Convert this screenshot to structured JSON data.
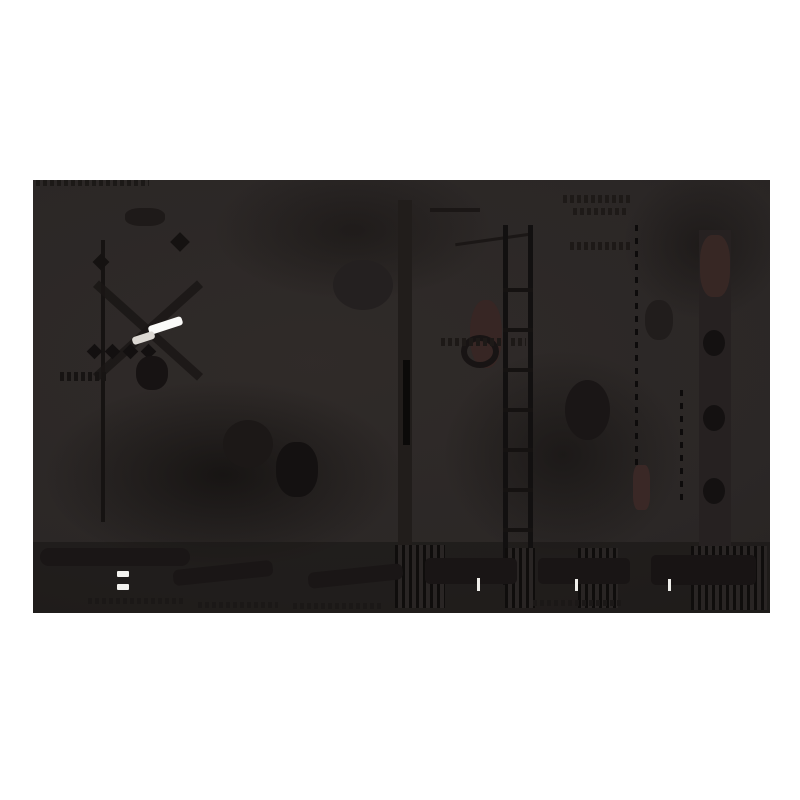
{
  "page": {
    "background_color": "#ffffff",
    "content_type": "underexposed dark photograph, letterboxed on white canvas"
  },
  "photo": {
    "frame": {
      "x": 33,
      "y": 180,
      "width": 737,
      "height": 433
    },
    "base_color": "#2b2726",
    "palette": {
      "base": "#2b2726",
      "deep_shadow": "#0f0d0c",
      "shadow": "#1a1615",
      "maroon_tint": "#382624",
      "highlight_white": "#fbfbf9",
      "dim_highlight": "#dcd8d3"
    },
    "shapes": [
      {
        "name": "soft-shadow-left",
        "kind": "soft",
        "x": 10,
        "y": 200,
        "w": 360,
        "h": 190,
        "color": "rgba(12,10,9,0.65)"
      },
      {
        "name": "soft-shadow-top-center",
        "kind": "soft",
        "x": 180,
        "y": -20,
        "w": 280,
        "h": 140,
        "color": "rgba(18,15,14,0.5)"
      },
      {
        "name": "soft-shadow-center-right",
        "kind": "soft",
        "x": 410,
        "y": 170,
        "w": 240,
        "h": 210,
        "color": "rgba(15,13,12,0.55)"
      },
      {
        "name": "soft-shadow-top-right",
        "kind": "soft",
        "x": 590,
        "y": -10,
        "w": 160,
        "h": 150,
        "color": "rgba(17,14,13,0.5)"
      },
      {
        "name": "bottom-strip",
        "kind": "solid",
        "x": 0,
        "y": 362,
        "w": 737,
        "h": 71,
        "color": "rgba(24,21,20,0.55)"
      },
      {
        "name": "caption-marks-top",
        "kind": "dashes",
        "x": 3,
        "y": 0,
        "w": 113,
        "h": 6,
        "color": "#1c1917"
      },
      {
        "name": "pole-left",
        "kind": "solid",
        "x": 68,
        "y": 60,
        "w": 4,
        "h": 282,
        "color": "#161312"
      },
      {
        "name": "pole-left-diamond",
        "kind": "solid",
        "x": 62,
        "y": 76,
        "w": 12,
        "h": 12,
        "rotate": 45,
        "color": "#151211"
      },
      {
        "name": "diagonal-bar-1",
        "kind": "solid",
        "x": 45,
        "y": 146,
        "w": 140,
        "h": 9,
        "rotate": 42,
        "color": "#1a1615",
        "opacity": 0.85
      },
      {
        "name": "diagonal-bar-2",
        "kind": "solid",
        "x": 45,
        "y": 146,
        "w": 140,
        "h": 9,
        "rotate": -42,
        "color": "#1a1615",
        "opacity": 0.85
      },
      {
        "name": "diamond-row-1",
        "kind": "solid",
        "x": 56,
        "y": 166,
        "w": 11,
        "h": 11,
        "rotate": 45,
        "color": "#131010"
      },
      {
        "name": "diamond-row-2",
        "kind": "solid",
        "x": 74,
        "y": 166,
        "w": 11,
        "h": 11,
        "rotate": 45,
        "color": "#131010"
      },
      {
        "name": "diamond-row-3",
        "kind": "solid",
        "x": 92,
        "y": 166,
        "w": 11,
        "h": 11,
        "rotate": 45,
        "color": "#131010"
      },
      {
        "name": "diamond-row-4",
        "kind": "solid",
        "x": 110,
        "y": 166,
        "w": 11,
        "h": 11,
        "rotate": 45,
        "color": "#131010"
      },
      {
        "name": "blob-under-streak",
        "kind": "solid",
        "x": 103,
        "y": 176,
        "w": 32,
        "h": 34,
        "color": "#171313",
        "radius": "45%"
      },
      {
        "name": "marks-left-w",
        "kind": "dashes",
        "x": 27,
        "y": 192,
        "w": 46,
        "h": 9,
        "color": "#171413"
      },
      {
        "name": "band-bottom-left",
        "kind": "solid",
        "x": 7,
        "y": 368,
        "w": 150,
        "h": 18,
        "color": "#1a1616",
        "radius": "9px"
      },
      {
        "name": "column-center",
        "kind": "solid",
        "x": 365,
        "y": 20,
        "w": 14,
        "h": 360,
        "color": "#211d1b"
      },
      {
        "name": "column-center-core",
        "kind": "solid",
        "x": 370,
        "y": 180,
        "w": 7,
        "h": 85,
        "color": "#0b0a09"
      },
      {
        "name": "line-top-center",
        "kind": "solid",
        "x": 397,
        "y": 28,
        "w": 50,
        "h": 4,
        "color": "#1b1716"
      },
      {
        "name": "line-mid-center",
        "kind": "solid",
        "x": 422,
        "y": 58,
        "w": 75,
        "h": 3,
        "rotate": -8,
        "color": "#1b1716"
      },
      {
        "name": "maroon-patch-center",
        "kind": "solid",
        "x": 437,
        "y": 120,
        "w": 32,
        "h": 68,
        "color": "#382624",
        "radius": "45%",
        "opacity": 0.9
      },
      {
        "name": "ring-center",
        "kind": "ring",
        "x": 428,
        "y": 155,
        "w": 38,
        "h": 33,
        "t": 6,
        "color": "#181414"
      },
      {
        "name": "marks-center-squiggle",
        "kind": "dashes",
        "x": 408,
        "y": 158,
        "w": 85,
        "h": 8,
        "color": "#1d1917"
      },
      {
        "name": "ladder-rail-left",
        "kind": "solid",
        "x": 470,
        "y": 45,
        "w": 5,
        "h": 360,
        "color": "#121010"
      },
      {
        "name": "ladder-rail-right",
        "kind": "solid",
        "x": 495,
        "y": 45,
        "w": 5,
        "h": 360,
        "color": "#121010"
      },
      {
        "name": "ladder-rungs",
        "kind": "stripes-h",
        "x": 470,
        "y": 108,
        "w": 30,
        "h": 244,
        "color": "#151211",
        "alt": "transparent"
      },
      {
        "name": "dotted-line-right",
        "kind": "dots-v",
        "x": 602,
        "y": 45,
        "w": 3,
        "h": 240,
        "color": "#0d0b0b"
      },
      {
        "name": "dotted-line-right-2",
        "kind": "dots-v",
        "x": 647,
        "y": 210,
        "w": 3,
        "h": 110,
        "color": "#0d0b0b"
      },
      {
        "name": "maroon-patch-lower-right",
        "kind": "solid",
        "x": 600,
        "y": 285,
        "w": 17,
        "h": 45,
        "color": "#3a2826",
        "radius": "30%"
      },
      {
        "name": "column-right",
        "kind": "solid",
        "x": 666,
        "y": 50,
        "w": 32,
        "h": 355,
        "color": "#262121"
      },
      {
        "name": "maroon-patch-right",
        "kind": "solid",
        "x": 667,
        "y": 55,
        "w": 30,
        "h": 62,
        "color": "#372724",
        "radius": "40%"
      },
      {
        "name": "right-blob-1",
        "kind": "solid",
        "x": 670,
        "y": 150,
        "w": 22,
        "h": 26,
        "color": "#141111",
        "radius": "50%"
      },
      {
        "name": "right-blob-2",
        "kind": "solid",
        "x": 670,
        "y": 225,
        "w": 22,
        "h": 26,
        "color": "#141111",
        "radius": "50%"
      },
      {
        "name": "right-blob-3",
        "kind": "solid",
        "x": 670,
        "y": 298,
        "w": 22,
        "h": 26,
        "color": "#141111",
        "radius": "50%"
      },
      {
        "name": "marks-top-right",
        "kind": "dashes",
        "x": 530,
        "y": 15,
        "w": 70,
        "h": 8,
        "color": "#1e1a18"
      },
      {
        "name": "marks-top-right-2",
        "kind": "dashes",
        "x": 540,
        "y": 28,
        "w": 55,
        "h": 7,
        "color": "#1e1a18"
      },
      {
        "name": "marks-mid-right",
        "kind": "dashes",
        "x": 537,
        "y": 62,
        "w": 60,
        "h": 8,
        "color": "#1d1917"
      },
      {
        "name": "blob-center-1",
        "kind": "solid",
        "x": 190,
        "y": 240,
        "w": 50,
        "h": 48,
        "color": "#1c1817",
        "radius": "50%"
      },
      {
        "name": "blob-center-2",
        "kind": "solid",
        "x": 243,
        "y": 262,
        "w": 42,
        "h": 55,
        "color": "#141111",
        "radius": "45%"
      },
      {
        "name": "blob-top-center",
        "kind": "solid",
        "x": 300,
        "y": 80,
        "w": 60,
        "h": 50,
        "color": "#242020",
        "radius": "50%"
      },
      {
        "name": "blob-top-left",
        "kind": "solid",
        "x": 92,
        "y": 28,
        "w": 40,
        "h": 18,
        "color": "#1e1a19",
        "radius": "40%"
      },
      {
        "name": "blob-mid-right",
        "kind": "solid",
        "x": 532,
        "y": 200,
        "w": 45,
        "h": 60,
        "color": "#1a1616",
        "radius": "50%"
      },
      {
        "name": "blob-right-upper",
        "kind": "solid",
        "x": 612,
        "y": 120,
        "w": 28,
        "h": 40,
        "color": "#211d1c",
        "radius": "45%"
      },
      {
        "name": "diamond-top",
        "kind": "solid",
        "x": 140,
        "y": 55,
        "w": 14,
        "h": 14,
        "rotate": 45,
        "color": "#151211"
      },
      {
        "name": "stripes-bottom-1",
        "kind": "stripes-v",
        "x": 362,
        "y": 365,
        "w": 50,
        "h": 63,
        "color": "#0f0d0c",
        "alt": "#292524"
      },
      {
        "name": "stripes-bottom-2",
        "kind": "stripes-v",
        "x": 472,
        "y": 368,
        "w": 30,
        "h": 60,
        "color": "#0f0d0c",
        "alt": "#292524"
      },
      {
        "name": "stripes-bottom-3",
        "kind": "stripes-v",
        "x": 545,
        "y": 368,
        "w": 40,
        "h": 60,
        "color": "#0f0d0c",
        "alt": "#292524"
      },
      {
        "name": "stripes-bottom-4",
        "kind": "stripes-v",
        "x": 658,
        "y": 366,
        "w": 76,
        "h": 64,
        "color": "#0f0d0c",
        "alt": "#292524"
      },
      {
        "name": "slab-bottom-left-1",
        "kind": "solid",
        "x": 140,
        "y": 385,
        "w": 100,
        "h": 16,
        "rotate": -6,
        "color": "#1a1616",
        "radius": "6px"
      },
      {
        "name": "slab-bottom-left-2",
        "kind": "solid",
        "x": 275,
        "y": 388,
        "w": 95,
        "h": 16,
        "rotate": -6,
        "color": "#1a1616",
        "radius": "6px"
      },
      {
        "name": "slab-bottom-1",
        "kind": "solid",
        "x": 392,
        "y": 378,
        "w": 92,
        "h": 26,
        "color": "#191515",
        "radius": "5px"
      },
      {
        "name": "slab-bottom-2",
        "kind": "solid",
        "x": 505,
        "y": 378,
        "w": 92,
        "h": 26,
        "color": "#191515",
        "radius": "5px"
      },
      {
        "name": "slab-bottom-3",
        "kind": "solid",
        "x": 618,
        "y": 375,
        "w": 105,
        "h": 30,
        "color": "#181414",
        "radius": "5px"
      },
      {
        "name": "caption-marks-bottom",
        "kind": "dashes",
        "x": 55,
        "y": 418,
        "w": 95,
        "h": 6,
        "color": "#1b1817"
      },
      {
        "name": "caption-marks-bottom-2",
        "kind": "dashes",
        "x": 165,
        "y": 422,
        "w": 80,
        "h": 6,
        "color": "#1b1817"
      },
      {
        "name": "caption-marks-bottom-3",
        "kind": "dashes",
        "x": 260,
        "y": 423,
        "w": 90,
        "h": 6,
        "color": "#1b1817"
      },
      {
        "name": "caption-marks-bottom-4",
        "kind": "dashes",
        "x": 500,
        "y": 420,
        "w": 90,
        "h": 6,
        "color": "#1b1817"
      },
      {
        "name": "highlight-streak-main",
        "kind": "solid",
        "x": 115,
        "y": 141,
        "w": 35,
        "h": 9,
        "rotate": -18,
        "color": "#fbfbf9",
        "radius": "3px"
      },
      {
        "name": "highlight-streak-tail",
        "kind": "solid",
        "x": 99,
        "y": 154,
        "w": 23,
        "h": 8,
        "rotate": -18,
        "color": "#dcd8d3",
        "radius": "3px"
      },
      {
        "name": "equals-mark-top",
        "kind": "solid",
        "x": 84,
        "y": 391,
        "w": 12,
        "h": 6,
        "color": "#f4f3f0",
        "radius": "1px"
      },
      {
        "name": "equals-mark-bottom",
        "kind": "solid",
        "x": 84,
        "y": 404,
        "w": 12,
        "h": 6,
        "color": "#f4f3f0",
        "radius": "1px"
      },
      {
        "name": "light-dash-1",
        "kind": "solid",
        "x": 444,
        "y": 398,
        "w": 3,
        "h": 13,
        "color": "#efeeea"
      },
      {
        "name": "light-dash-2",
        "kind": "solid",
        "x": 542,
        "y": 399,
        "w": 3,
        "h": 12,
        "color": "#efeeea"
      },
      {
        "name": "light-dash-3",
        "kind": "solid",
        "x": 635,
        "y": 399,
        "w": 3,
        "h": 12,
        "color": "#efeeea"
      }
    ]
  }
}
